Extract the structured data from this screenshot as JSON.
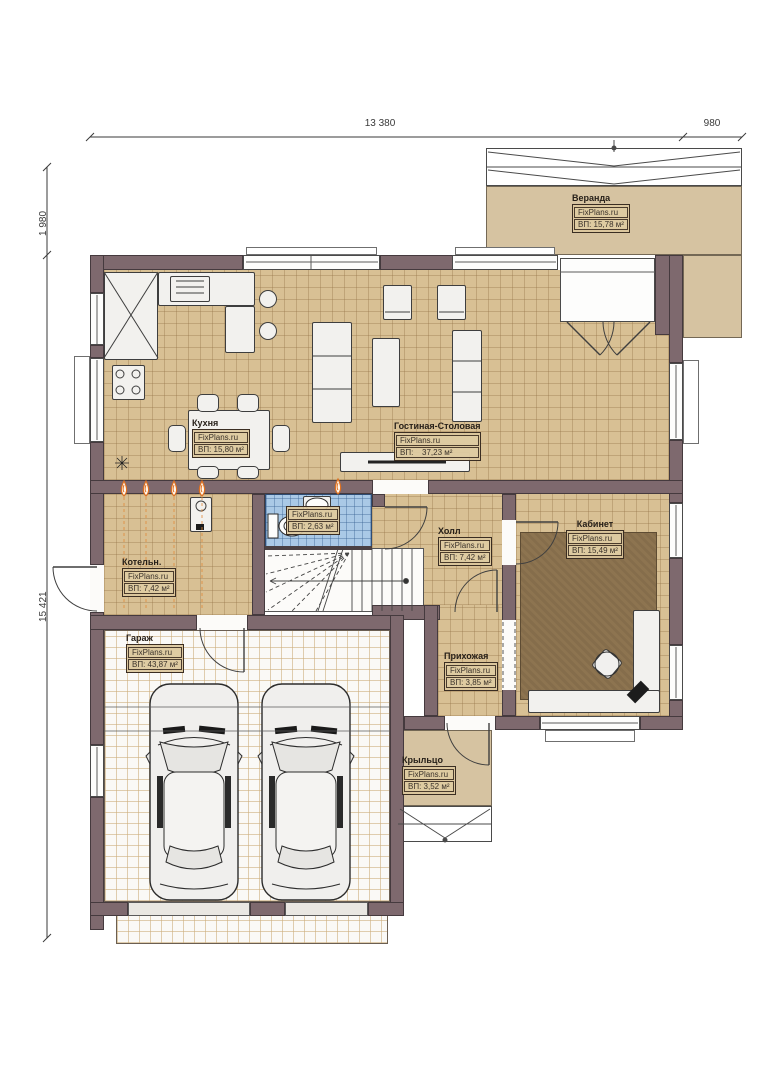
{
  "brand_watermark": "FixPlans.ru",
  "dimensions": {
    "width_main": "13 380",
    "width_veranda": "980",
    "offset_top": "1 980",
    "height_main": "15 421"
  },
  "rooms": [
    {
      "id": "veranda",
      "name": "Веранда",
      "brand": "FixPlans.ru",
      "area": "ВП: 15,78 м²"
    },
    {
      "id": "kitchen",
      "name": "Кухня",
      "brand": "FixPlans.ru",
      "area": "ВП: 15,80 м²"
    },
    {
      "id": "living_dining",
      "name": "Гостиная-Столовая",
      "brand": "FixPlans.ru",
      "area_prefix": "ВП:",
      "area_value": "37,23 м²"
    },
    {
      "id": "boiler",
      "name": "Котельн.",
      "brand": "FixPlans.ru",
      "area": "ВП: 7,42 м²"
    },
    {
      "id": "bathroom",
      "name": "",
      "brand": "FixPlans.ru",
      "area": "ВП: 2,63 м²"
    },
    {
      "id": "hall",
      "name": "Холл",
      "brand": "FixPlans.ru",
      "area": "ВП: 7,42 м²"
    },
    {
      "id": "office",
      "name": "Кабинет",
      "brand": "FixPlans.ru",
      "area": "ВП: 15,49 м²"
    },
    {
      "id": "garage",
      "name": "Гараж",
      "brand": "FixPlans.ru",
      "area": "ВП: 43,87 м²"
    },
    {
      "id": "entry_hall",
      "name": "Прихожая",
      "brand": "FixPlans.ru",
      "area": "ВП: 3,85 м²"
    },
    {
      "id": "porch",
      "name": "Крыльцо",
      "brand": "FixPlans.ru",
      "area": "ВП: 3,52 м²"
    }
  ],
  "colors": {
    "wall": "#7e696e",
    "tile_floor": "#d8c094",
    "veranda_floor": "#d6c3a1",
    "bathroom_tile": "#aac9e6",
    "office_rug": "#8d7450",
    "flame_accent": "#dd7020"
  }
}
